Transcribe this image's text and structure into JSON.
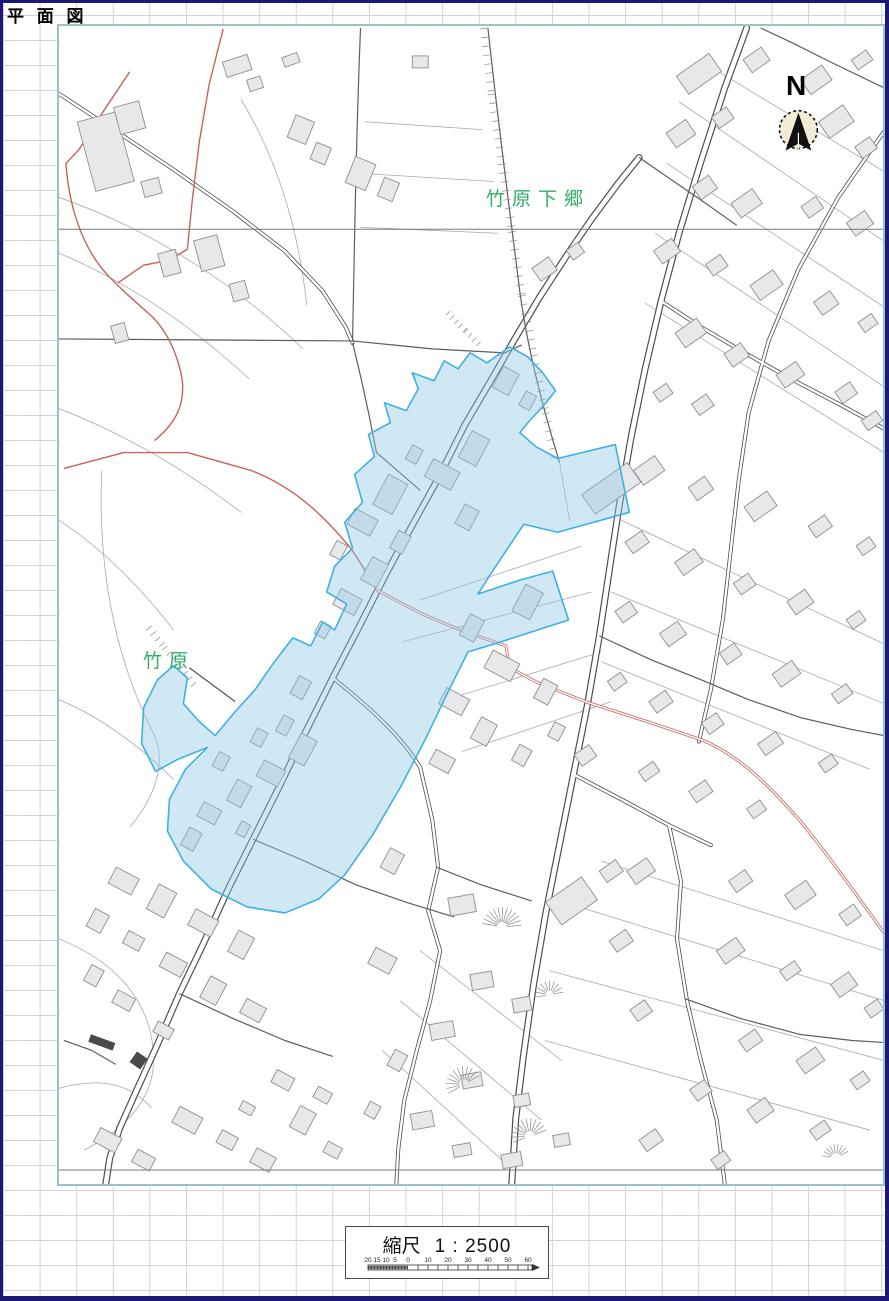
{
  "page": {
    "title": "平 面 図"
  },
  "map": {
    "area_labels": [
      {
        "text": "竹原下郷"
      },
      {
        "text": "竹原"
      }
    ],
    "north_label": "N",
    "colors": {
      "highlight_fill": "#cfe4ef",
      "highlight_outline": "#3fb0e4",
      "road": "#4d4d4d",
      "red_road": "#c4635a",
      "building_fill": "#e8e8ea",
      "building_outline": "#8f8f91",
      "label_green": "#2eae68",
      "map_frame": "#9cc0cb",
      "page_border": "#1c1878",
      "grid_line": "#ccd4e0"
    }
  },
  "scale_box": {
    "prefix": "縮尺",
    "ratio": "1 : 2500",
    "bar": {
      "left_labels": [
        "20",
        "15",
        "10",
        "5"
      ],
      "zero_label": "0",
      "right_labels": [
        "10",
        "20",
        "30",
        "40",
        "50",
        "60"
      ]
    }
  }
}
